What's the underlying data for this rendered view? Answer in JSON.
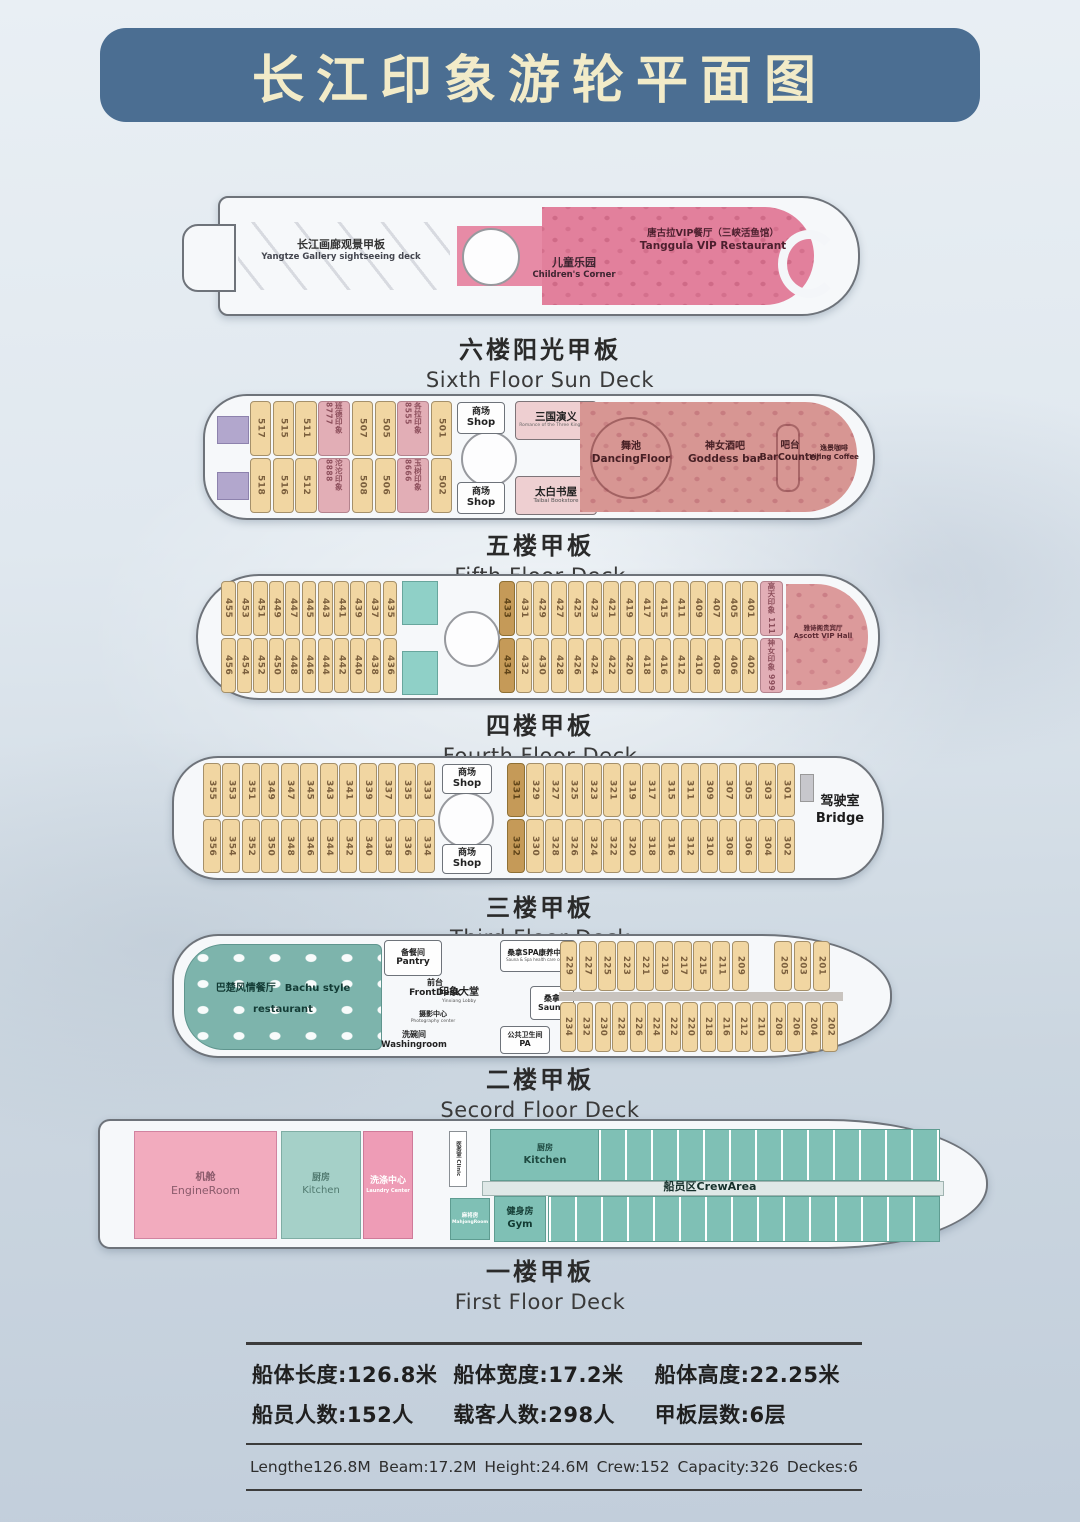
{
  "title": "长江印象游轮平面图",
  "decks": {
    "six": {
      "label_cn": "六楼阳光甲板",
      "label_en": "Sixth Floor Sun Deck",
      "gallery_cn": "长江画廊观景甲板",
      "gallery_en": "Yangtze Gallery sightseeing deck",
      "children_cn": "儿童乐园",
      "children_en": "Children's Corner",
      "vip_cn": "唐古拉VIP餐厅（三峡活鱼馆）",
      "vip_en": "Tanggula VIP Restaurant"
    },
    "five": {
      "label_cn": "五楼甲板",
      "label_en": "Fifth Floor Deck",
      "rooms_top": [
        "517",
        "515",
        "511",
        {
          "n": "班德印象 8777",
          "c": "suite"
        },
        "507",
        "505",
        {
          "n": "各拉印象 8555",
          "c": "suite"
        },
        "501"
      ],
      "rooms_bottom": [
        "518",
        "516",
        "512",
        {
          "n": "沱沱印象 8888",
          "c": "suite"
        },
        "508",
        "506",
        {
          "n": "玉树印象 8666",
          "c": "suite"
        },
        "502"
      ],
      "shop_cn": "商场",
      "shop_en": "Shop",
      "sanguo_cn": "三国演义",
      "sanguo_en": "Romance of the Three Kingdoms",
      "taibai_cn": "太白书屋",
      "taibai_en": "Taibai Bookstore",
      "dance_cn": "舞池",
      "dance_en": "DancingFloor",
      "goddess_cn": "神女酒吧",
      "goddess_en": "Goddess bar",
      "bar_cn": "吧台",
      "bar_en": "BarCounter",
      "coffee_cn": "逸景咖啡",
      "coffee_en": "Yijing Coffee"
    },
    "four": {
      "label_cn": "四楼甲板",
      "label_en": "Fourth Floor Deck",
      "rooms_top_left": [
        "455",
        "453",
        "451",
        "449",
        "447",
        "445",
        "443",
        "441",
        "439",
        "437",
        "435"
      ],
      "rooms_top_right": [
        {
          "n": "433",
          "c": "tan"
        },
        "431",
        "429",
        "427",
        "425",
        "423",
        "421",
        "419",
        "417",
        "415",
        "411",
        "409",
        "407",
        "405",
        "401",
        {
          "n": "高天印象 111",
          "c": "suite"
        }
      ],
      "rooms_bottom_left": [
        "456",
        "454",
        "452",
        "450",
        "448",
        "446",
        "444",
        "442",
        "440",
        "438",
        "436"
      ],
      "rooms_bottom_right": [
        {
          "n": "434",
          "c": "tan"
        },
        "432",
        "430",
        "428",
        "426",
        "424",
        "422",
        "420",
        "418",
        "416",
        "412",
        "410",
        "408",
        "406",
        "402",
        {
          "n": "神女印象 999",
          "c": "suite"
        }
      ],
      "ascott_cn": "雅诗阁贵宾厅",
      "ascott_en": "Ascott VIP Hall"
    },
    "three": {
      "label_cn": "三楼甲板",
      "label_en": "Third Floor Deck",
      "rooms_top_left": [
        "355",
        "353",
        "351",
        "349",
        "347",
        "345",
        "343",
        "341",
        "339",
        "337",
        "335",
        "333"
      ],
      "rooms_top_right": [
        {
          "n": "331",
          "c": "tan"
        },
        "329",
        "327",
        "325",
        "323",
        "321",
        "319",
        "317",
        "315",
        "311",
        "309",
        "307",
        "305",
        "303",
        "301"
      ],
      "rooms_bottom_left": [
        "356",
        "354",
        "352",
        "350",
        "348",
        "346",
        "344",
        "342",
        "340",
        "338",
        "336",
        "334"
      ],
      "rooms_bottom_right": [
        {
          "n": "332",
          "c": "tan"
        },
        "330",
        "328",
        "326",
        "324",
        "322",
        "320",
        "318",
        "316",
        "312",
        "310",
        "308",
        "306",
        "304",
        "302"
      ],
      "shop_cn": "商场",
      "shop_en": "Shop",
      "bridge_cn": "驾驶室",
      "bridge_en": "Bridge"
    },
    "two": {
      "label_cn": "二楼甲板",
      "label_en": "Secord Floor Deck",
      "restaurant_cn": "巴楚风情餐厅",
      "restaurant_en": "Bachu style restaurant",
      "pantry_cn": "备餐间",
      "pantry_en": "Pantry",
      "front_cn": "前台",
      "front_en": "FrontDesk",
      "lobby_cn": "印象大堂",
      "lobby_en": "Yinxiang Lobby",
      "photo_cn": "摄影中心",
      "photo_en": "Photography center",
      "wash_cn": "洗碗间",
      "wash_en": "Washingroom",
      "spa_cn": "桑拿SPA康养中心",
      "spa_en": "Sauna & Spa health care center",
      "sauna_cn": "桑拿",
      "sauna_en": "Sauna",
      "pa_cn": "公共卫生间",
      "pa_en": "PA",
      "rooms_top": [
        "229",
        "227",
        "225",
        "223",
        "221",
        "219",
        "217",
        "215",
        "211",
        "209",
        {
          "n": "",
          "c": "spacer"
        },
        "205",
        "203",
        "201"
      ],
      "rooms_bottom": [
        "234",
        "232",
        "230",
        "228",
        "226",
        "224",
        "222",
        "220",
        "218",
        "216",
        "212",
        "210",
        "208",
        "206",
        "204",
        "202"
      ]
    },
    "one": {
      "label_cn": "一楼甲板",
      "label_en": "First Floor Deck",
      "engine_cn": "机舱",
      "engine_en": "EngineRoom",
      "kitchen_cn": "厨房",
      "kitchen_en": "Kitchen",
      "laundry_cn": "洗涤中心",
      "laundry_en": "Laundry Center",
      "clinic_cn": "医务室",
      "clinic_en": "Clinic",
      "kitchen2_cn": "厨房",
      "kitchen2_en": "Kitchen",
      "crew": "船员区CrewArea",
      "mahjong_cn": "麻将房",
      "mahjong_en": "MahjongRoom",
      "gym_cn": "健身房",
      "gym_en": "Gym"
    }
  },
  "specs": {
    "cn": [
      "船体长度:126.8米",
      "船体宽度:17.2米",
      "船体高度:22.25米",
      "船员人数:152人",
      "载客人数:298人",
      "甲板层数:6层"
    ],
    "en": [
      "Lengthe126.8M",
      "Beam:17.2M",
      "Height:24.6M",
      "Crew:152",
      "Capacity:326",
      "Deckes:6"
    ]
  }
}
